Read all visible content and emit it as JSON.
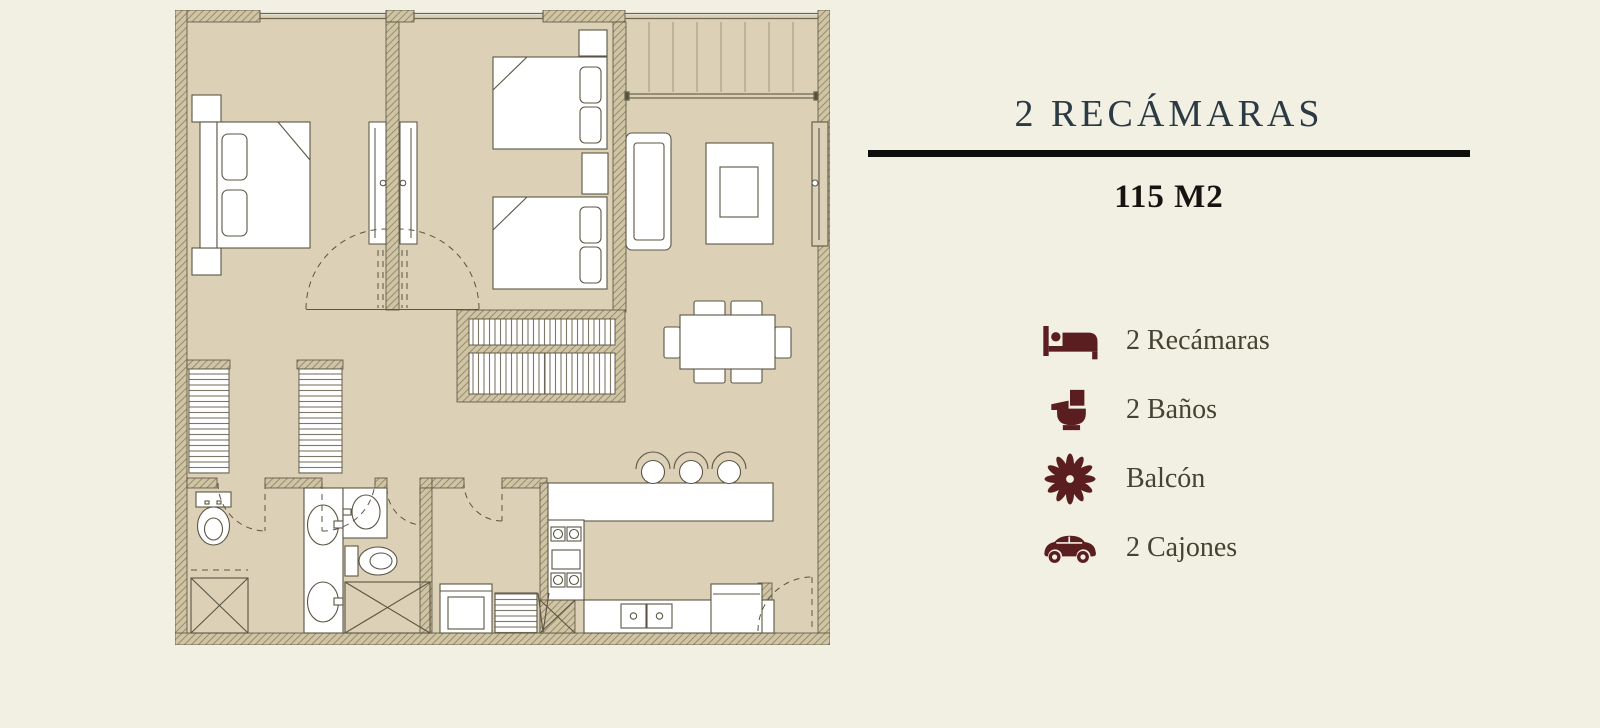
{
  "panel": {
    "title": "2 RECÁMARAS",
    "area": "115 M2",
    "features": [
      {
        "icon": "bed-icon",
        "label": "2 Recámaras"
      },
      {
        "icon": "toilet-icon",
        "label": "2 Baños"
      },
      {
        "icon": "flower-icon",
        "label": "Balcón"
      },
      {
        "icon": "car-icon",
        "label": "2 Cajones"
      }
    ]
  },
  "floor_plan": {
    "description": "Architectural plan of a two-bedroom apartment",
    "depicted_rooms": [
      "bedroom-1",
      "bedroom-2",
      "balcony",
      "living-room",
      "dining-area",
      "kitchen",
      "bathroom-1",
      "bathroom-2",
      "closets",
      "laundry-area"
    ],
    "depicted_furniture": [
      "double-bed",
      "twin-beds",
      "wardrobes",
      "sofa",
      "coffee-table-rug",
      "dining-table-6-chairs",
      "bar-counter-3-stools",
      "stove",
      "kitchen-sink",
      "fridge",
      "washer",
      "toilets",
      "vanity-sinks",
      "showers"
    ]
  },
  "colors": {
    "page_background": "#f2efe3",
    "plan_floor": "#dcd1b6",
    "wall_hatch": "#cfc4a4",
    "line": "#55503e",
    "title": "#2c3a43",
    "divider": "#0d0d0b",
    "icon_maroon": "#5a1e21",
    "feature_text": "#454331"
  }
}
